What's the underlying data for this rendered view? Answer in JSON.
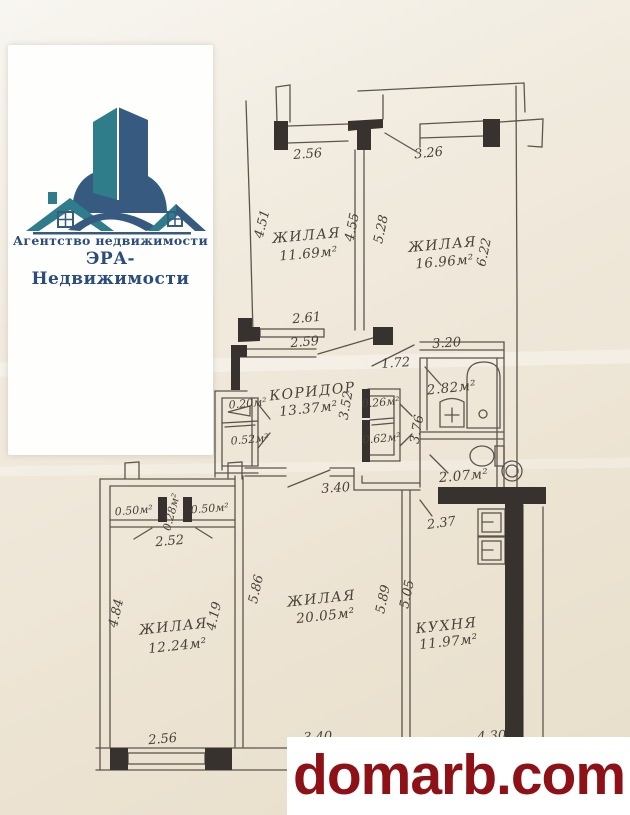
{
  "logo": {
    "line1": "Агентство недвижимости",
    "line2": "ЭРА-Недвижимости",
    "teal_color": "#2f7c8a",
    "blue_color": "#365a80",
    "text_color": "#2b4d7c"
  },
  "watermark": {
    "text": "domarb.com",
    "color": "#8e1118"
  },
  "plan": {
    "rooms": {
      "living1": {
        "name": "ЖИЛАЯ",
        "area": "11.69м²"
      },
      "living2": {
        "name": "ЖИЛАЯ",
        "area": "16.96м²"
      },
      "corridor": {
        "name": "КОРИДОР",
        "area": "13.37м²"
      },
      "bath": {
        "area": "2.82м²"
      },
      "wc": {
        "area": "2.07м²"
      },
      "living3": {
        "name": "ЖИЛАЯ",
        "area": "12.24м²"
      },
      "living4": {
        "name": "ЖИЛАЯ",
        "area": "20.05м²"
      },
      "kitchen": {
        "name": "КУХНЯ",
        "area": "11.97м²"
      },
      "closetL1": {
        "area": "0.20м²"
      },
      "closetL2": {
        "area": "0.52м²"
      },
      "closetR1": {
        "area": "0.26м²"
      },
      "closetR2": {
        "area": "0.62м²"
      },
      "pantry1": {
        "area": "0.50м²"
      },
      "pantry2": {
        "area": "0.28м²"
      },
      "pantry3": {
        "area": "0.50м²"
      }
    },
    "dims": {
      "top_r1": "2.56",
      "top_r2": "3.26",
      "left_r1": "4.51",
      "right_r1": "4.55",
      "left_r2": "5.28",
      "right_r2": "6.22",
      "win_r1": "2.61",
      "bottom_r1": "2.59",
      "pass_r2": "1.72",
      "top_bath": "3.20",
      "corr_v1": "3.52",
      "corr_v2": "3.76",
      "hall": "3.40",
      "kitchen_top": "2.37",
      "pantry_row": "2.52",
      "left_r3": "4.84",
      "right_r3": "4.19",
      "left_r4": "5.86",
      "right_r4": "5.89",
      "left_k": "5.05",
      "bottom_r3": "2.56",
      "bottom_r4": "3.40",
      "bottom_k": "4.30"
    }
  }
}
